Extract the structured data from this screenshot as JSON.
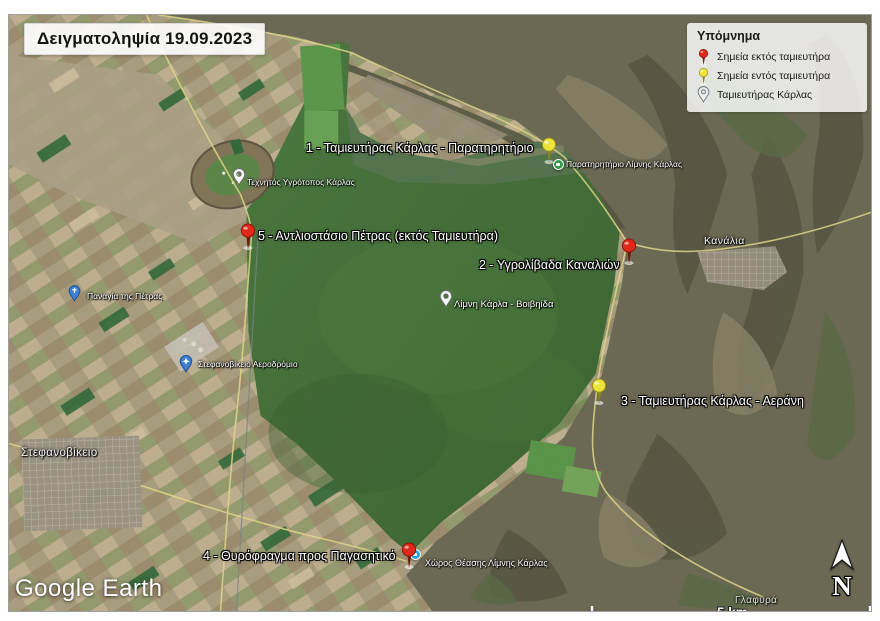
{
  "title": "Δειγματοληψία 19.09.2023",
  "legend": {
    "title": "Υπόμνημα",
    "items": [
      {
        "icon": "red-pushpin-icon",
        "label": "Σημεία εκτός ταμιευτήρα"
      },
      {
        "icon": "yellow-pushpin-icon",
        "label": "Σημεία εντός ταμιευτήρα"
      },
      {
        "icon": "gray-placemark-icon",
        "label": "Ταμιευτήρας Κάρλας"
      }
    ]
  },
  "samples": [
    {
      "num": "1",
      "pin": "yellow",
      "label": "1 - Ταμιευτήρας Κάρλας - Παρατηρητήριο"
    },
    {
      "num": "2",
      "pin": "red",
      "label": "2 - Υγρολίβαδα Καναλιών"
    },
    {
      "num": "3",
      "pin": "yellow",
      "label": "3 - Ταμιευτήρας Κάρλας - Αεράνη"
    },
    {
      "num": "4",
      "pin": "red",
      "label": "4 - Θυρόφραγμα προς Παγασητικό"
    },
    {
      "num": "5",
      "pin": "red",
      "label": "5 - Αντλιοστάσιο Πέτρας (εκτός Ταμιευτήρα)"
    }
  ],
  "pois": [
    {
      "icon": "green-viewpoint-icon",
      "label": "Παρατηρητήριο Λίμνης Κάρλας"
    },
    {
      "icon": "white-placemark-icon",
      "label": "Τεχνητός Υγρότοπος Κάρλας"
    },
    {
      "icon": "white-placemark-icon",
      "label": "Λίμνη Κάρλα - Βοιβηίδα"
    },
    {
      "icon": "blue-church-icon",
      "label": "Παναγία της Πέτρας"
    },
    {
      "icon": "blue-airport-icon",
      "label": "Στεφανοβίκειο Αεροδρόμιο"
    },
    {
      "icon": "blue-viewpoint-icon",
      "label": "Χώρος Θέασης Λίμνης Κάρλας"
    }
  ],
  "places": [
    {
      "label": "Κανάλια"
    },
    {
      "label": "Στεφανοβίκειο"
    },
    {
      "label": "Γλαφυρά"
    }
  ],
  "map_chrome": {
    "attribution": "Google Earth",
    "scale_label": "5 km",
    "north_label": "N"
  },
  "colors": {
    "red_pin": "#e02818",
    "yellow_pin": "#ece43a",
    "lake_green": "#44753a",
    "farmland": "#b3a287",
    "mountain": "#6d6a54"
  }
}
